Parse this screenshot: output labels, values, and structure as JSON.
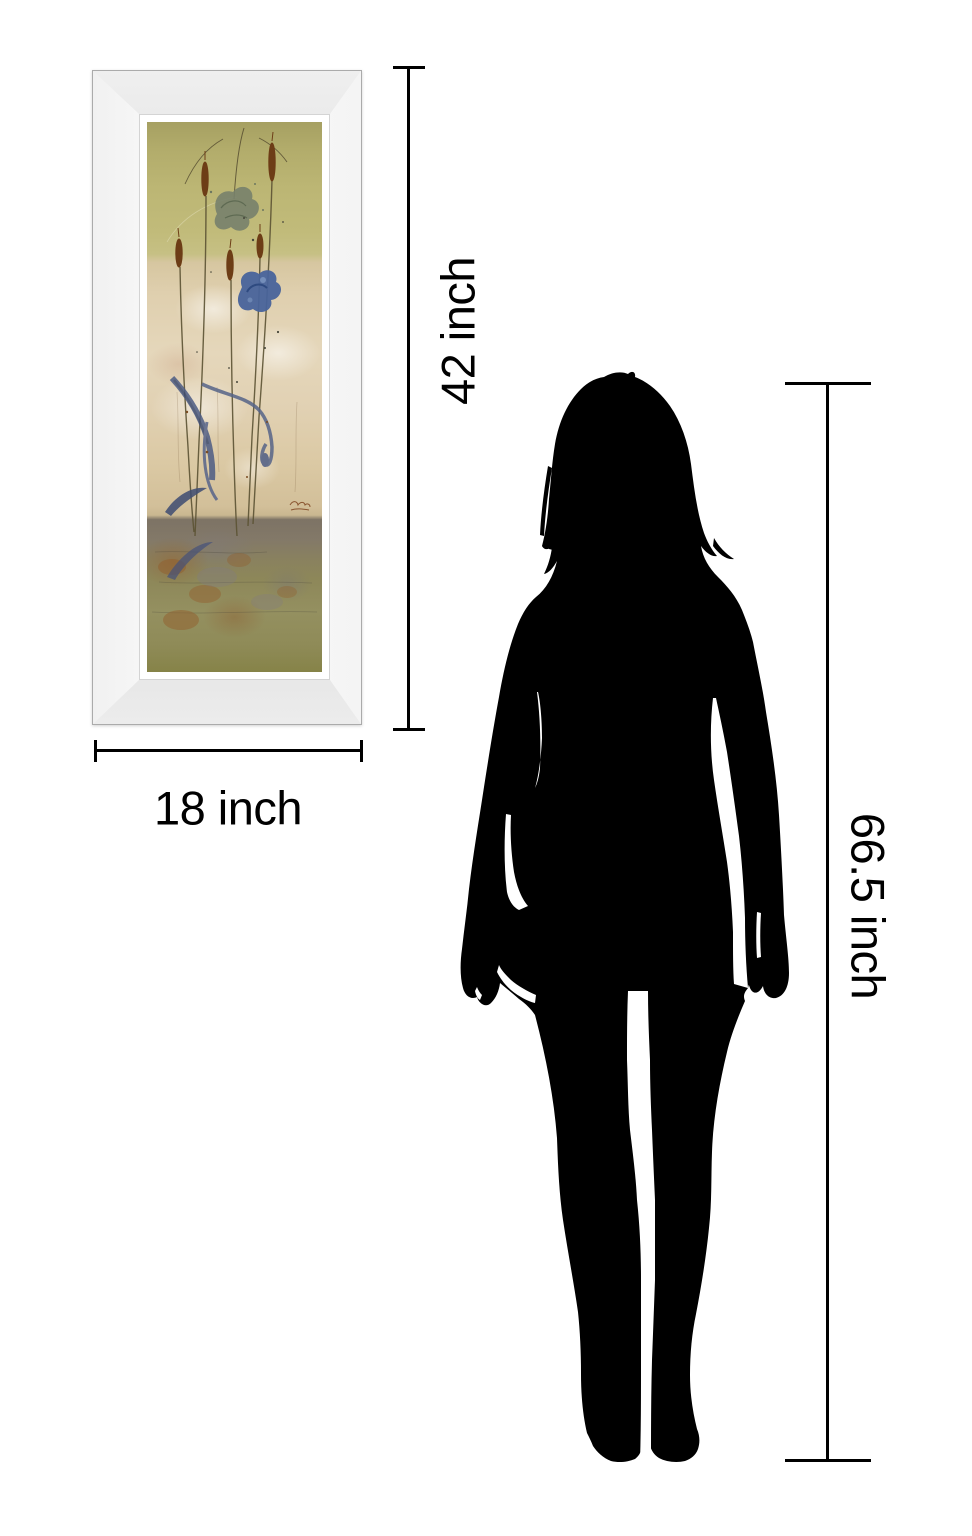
{
  "page": {
    "type": "product size comparison diagram",
    "background_color": "#ffffff"
  },
  "framed_print": {
    "name": "mirror framed floral art print",
    "frame": {
      "style": "beveled mirror frame",
      "light_color": "#fafafa",
      "dark_color": "#8f8f8f",
      "liner_color": "#ffffff"
    },
    "art": {
      "top_band_color": "#bcb674",
      "middle_band_color": "#e2d2b4",
      "bottom_band_color": "#8d8759",
      "cattail_color": "#6d3d16",
      "sage_flower_color": "#77816b",
      "blue_flower_color": "#48639b",
      "leaf_blue_color": "#57648a"
    }
  },
  "person": {
    "name": "standing woman silhouette",
    "color": "#000000"
  },
  "measurements": {
    "line_color": "#000000",
    "frame_height": {
      "label": "42 inch",
      "value": 42,
      "unit": "inch"
    },
    "frame_width": {
      "label": "18 inch",
      "value": 18,
      "unit": "inch"
    },
    "person_height": {
      "label": "66.5 inch",
      "value": 66.5,
      "unit": "inch"
    }
  }
}
